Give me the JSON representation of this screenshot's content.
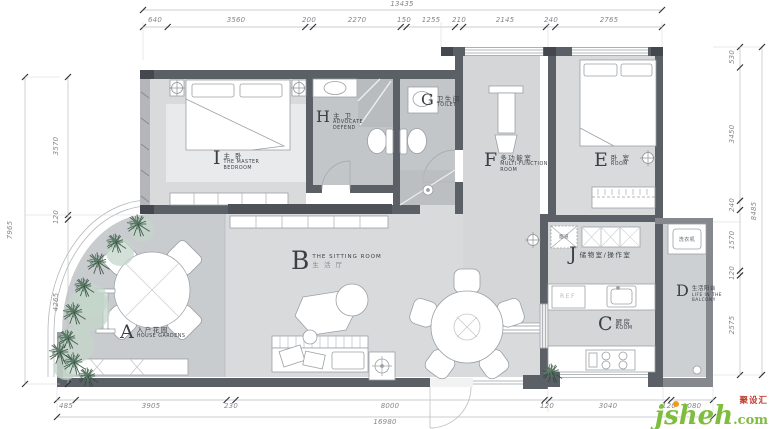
{
  "title": "apartment-floor-plan",
  "dimensions": {
    "top_total": "13435",
    "top_segments": [
      "640",
      "3560",
      "200",
      "2270",
      "150",
      "1255",
      "210",
      "2145",
      "240",
      "2765"
    ],
    "bottom_total": "16980",
    "bottom_segments": [
      "485",
      "3905",
      "230",
      "8000",
      "120",
      "3040",
      "120",
      "1080"
    ],
    "left_total": "7965",
    "left_segments": [
      "3570",
      "120",
      "4265"
    ],
    "right_total": "8485",
    "right_segments": [
      "530",
      "3450",
      "240",
      "1570",
      "120",
      "2575"
    ]
  },
  "rooms": {
    "A": {
      "letter": "A",
      "l1": "入户花园",
      "l2": "HOUSE GARDENS"
    },
    "B": {
      "letter": "B",
      "l1": "THE SITTING ROOM",
      "l2": "生 活 厅"
    },
    "C": {
      "letter": "C",
      "l1": "厨房",
      "l2": "ROOM"
    },
    "D": {
      "letter": "D",
      "l1": "生活阳台",
      "l2": "LIFE IN THE",
      "l3": "BALCONY"
    },
    "E": {
      "letter": "E",
      "l1": "卧 室",
      "l2": "ROOM"
    },
    "F": {
      "letter": "F",
      "l1": "多功能室",
      "l2": "MULTI-FUNCTION",
      "l3": "ROOM"
    },
    "G": {
      "letter": "G",
      "l1": "卫生间",
      "l2": "TOILET"
    },
    "H": {
      "letter": "H",
      "l1": "主 卫",
      "l2": "ADVOCATE",
      "l3": "DEFEND"
    },
    "I": {
      "letter": "I",
      "l1": "主 卧",
      "l2": "THE MASTER",
      "l3": "BEDROOM"
    },
    "J": {
      "letter": "J",
      "l1": "储物室/操作室"
    }
  },
  "annotations": {
    "flue": "烟道",
    "washer": "洗衣机",
    "fridge": "REF"
  },
  "watermark": {
    "brand": "jsheh",
    "tld": ".com",
    "badge": "聚设汇"
  },
  "colors": {
    "wall": "#5b5f66",
    "floor": "#d9dadc",
    "bath": "#c3c6c9",
    "accent_green": "#7fbd3e"
  }
}
